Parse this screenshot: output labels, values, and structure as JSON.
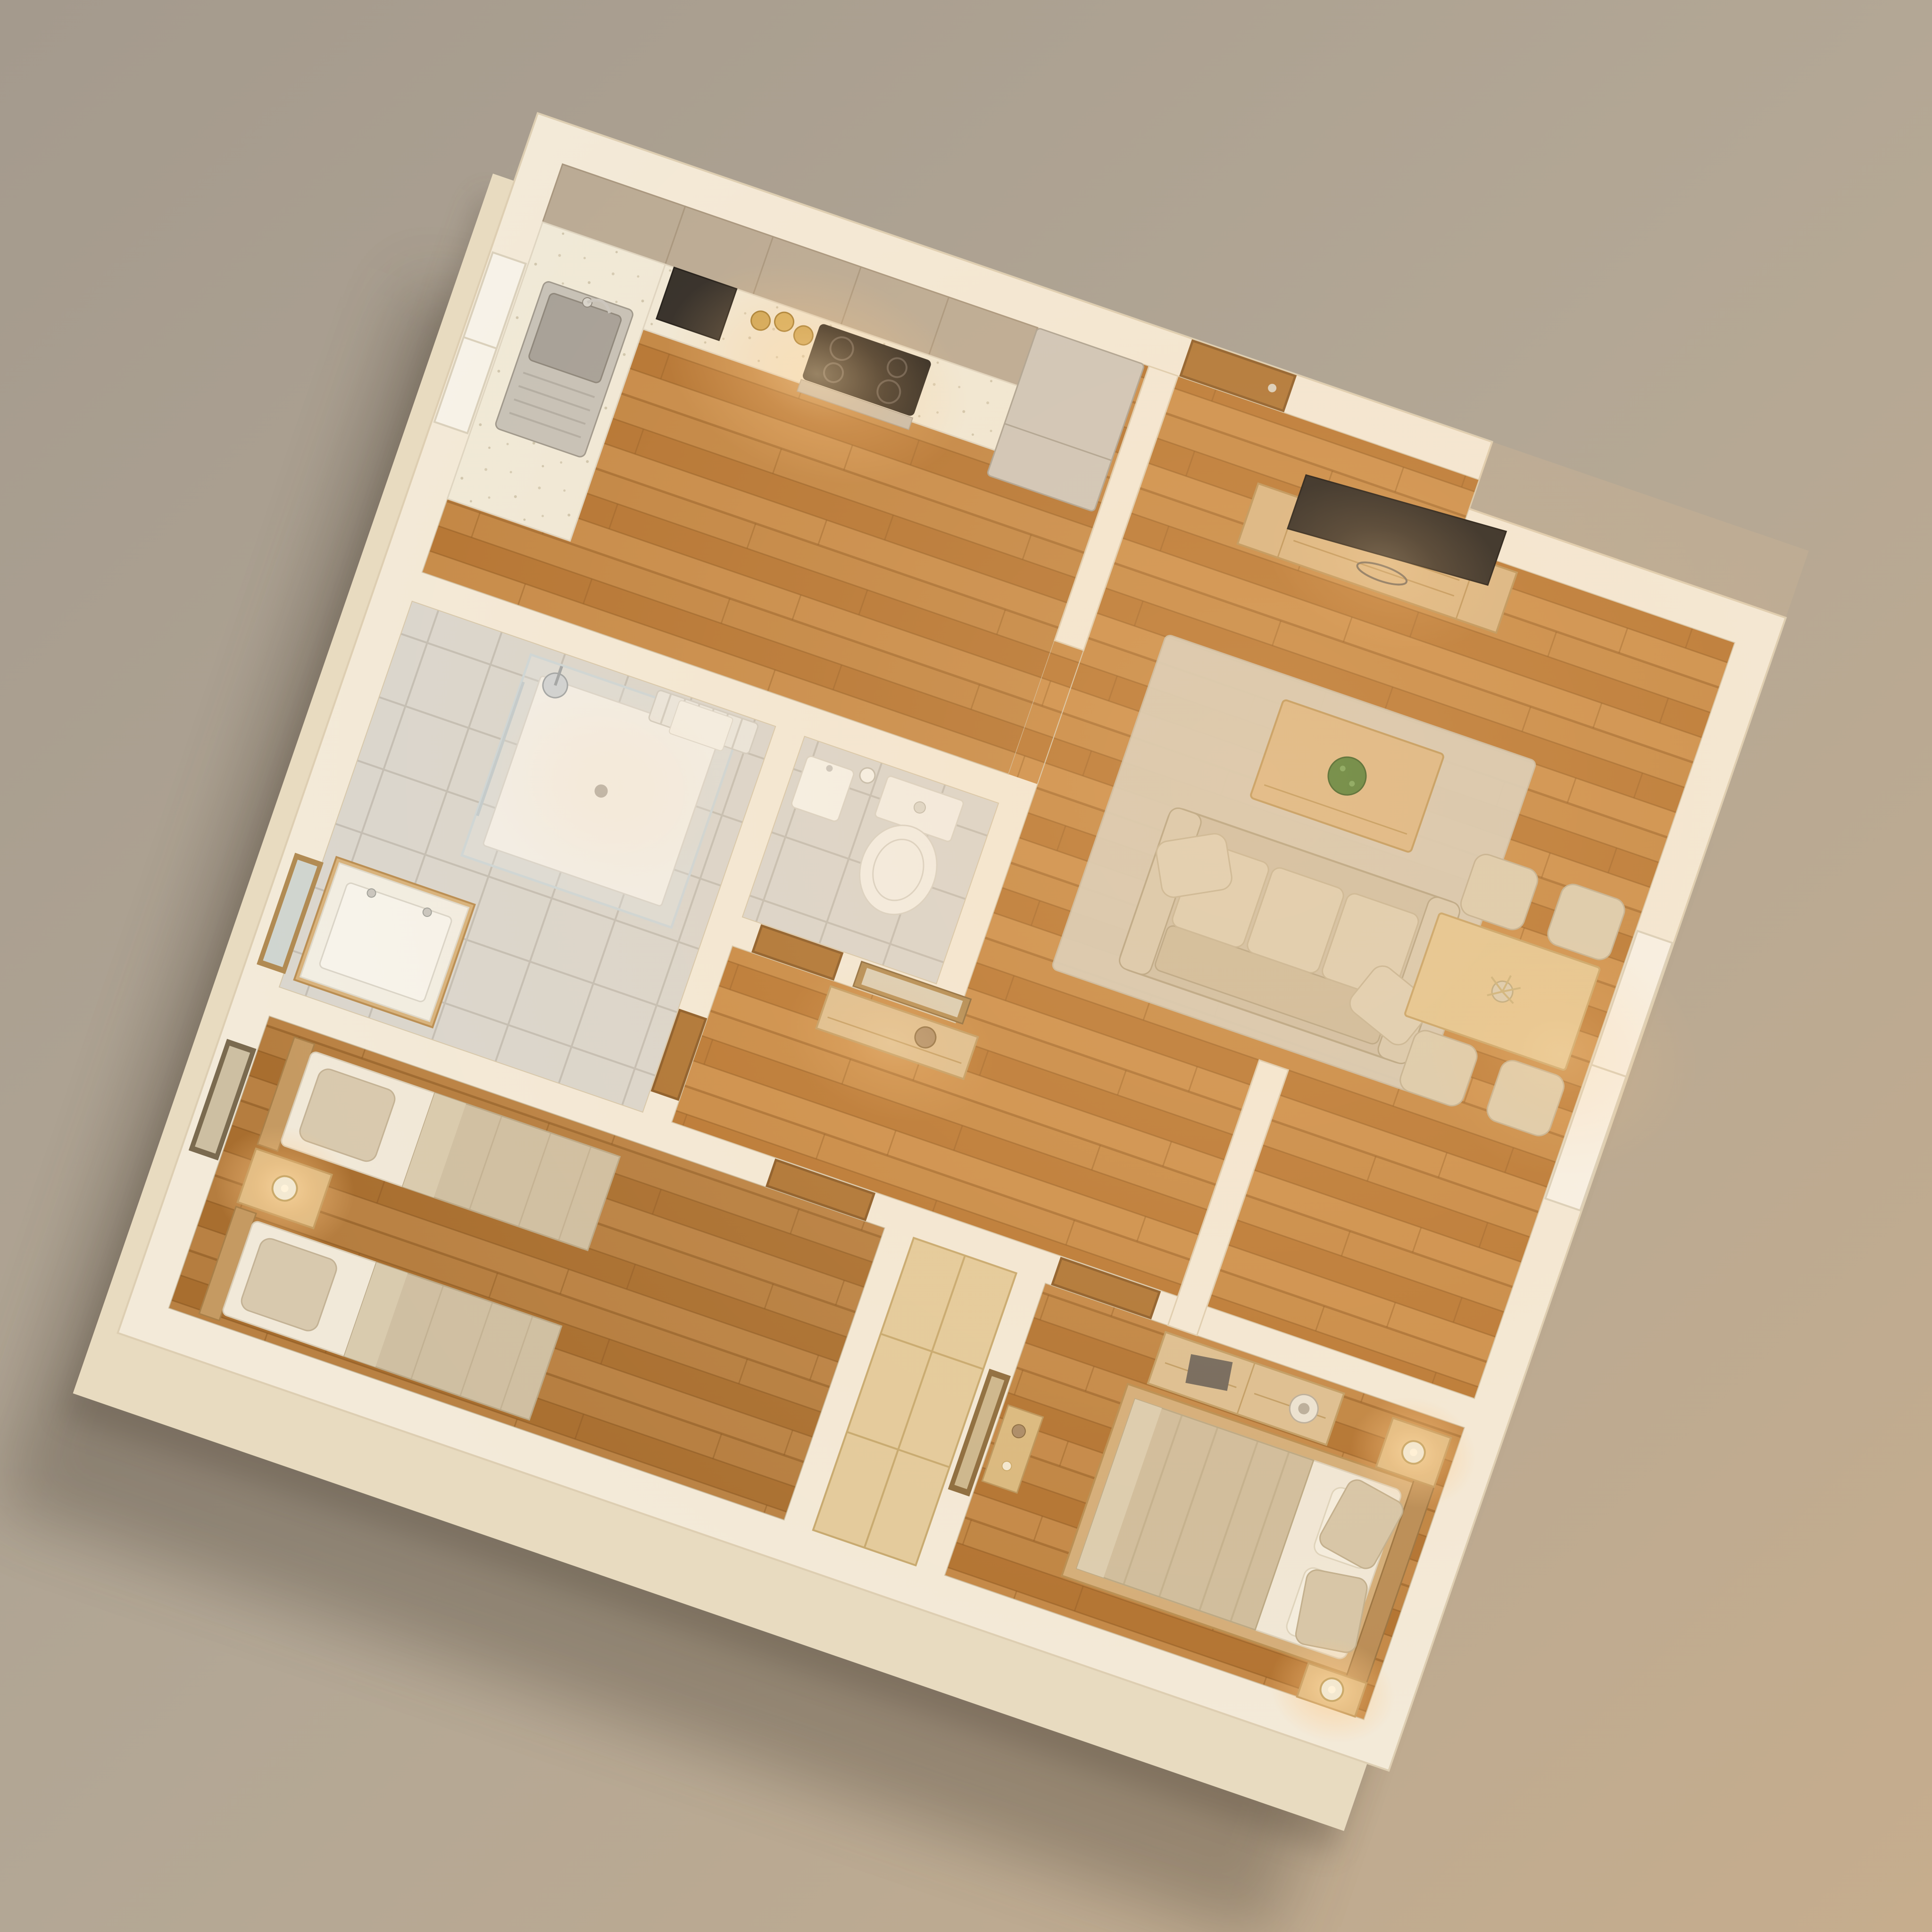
{
  "scene": {
    "type": "3d-floor-plan-render",
    "description": "Isometric top-down 3D render of a two-bedroom apartment miniature model, warm evening lighting, on a plain beige studio background",
    "rotation_deg": 19,
    "text_labels": []
  },
  "palette": {
    "background_top": "#a49a8d",
    "background_mid": "#b3a795",
    "background_bottom": "#c6ad8d",
    "wall_top": "#f3ead9",
    "wall_side": "#e8dbc0",
    "cast_shadow": "#3a3028",
    "floor_wood": "#c08038",
    "floor_tile": "#dad6ce",
    "door_wood": "#ad7434",
    "door_frame": "#8a5a26",
    "cabinet_greige": "#b9aa95",
    "countertop": "#f0ead9",
    "stainless": "#cdc6bb",
    "cooktop_black": "#191715",
    "textile_beige": "#cfc0a6",
    "textile_white": "#f1e9d9",
    "blanket_beige": "#cfbd9d",
    "oak_furniture": "#d9b684",
    "wardrobe_oak": "#e3cb9c",
    "rug": "#d7cdb9",
    "plant_green": "#58813a",
    "lamp_glow": "#ffd9a0",
    "glass": "#cdd6d8"
  },
  "rooms": [
    {
      "name": "kitchen",
      "floor": "wood",
      "furniture": [
        "upper-cabinets",
        "corner-cabinet",
        "speckled-countertop",
        "microwave",
        "gold-canisters",
        "induction-cooktop",
        "oven",
        "stainless-sink",
        "fridge",
        "window"
      ]
    },
    {
      "name": "living-room",
      "floor": "wood",
      "furniture": [
        "entrance-door",
        "tv-console",
        "flat-tv",
        "area-rug",
        "coffee-table",
        "green-plant",
        "three-seat-sofa",
        "throw-pillows"
      ]
    },
    {
      "name": "dining-area",
      "floor": "wood",
      "furniture": [
        "dining-table",
        "flower-centerpiece",
        "chair",
        "chair",
        "chair",
        "chair",
        "tall-window"
      ]
    },
    {
      "name": "bathroom",
      "floor": "tile",
      "furniture": [
        "walk-in-shower",
        "shower-head",
        "towel-radiator",
        "vanity-sink",
        "wall-mirror",
        "door"
      ]
    },
    {
      "name": "wc",
      "floor": "tile",
      "furniture": [
        "toilet",
        "corner-sink",
        "toilet-paper-holder",
        "door"
      ]
    },
    {
      "name": "hallway",
      "floor": "wood",
      "furniture": [
        "console-table",
        "wall-mirror",
        "decor-bowl"
      ]
    },
    {
      "name": "bedroom-twin",
      "floor": "wood",
      "furniture": [
        "single-bed",
        "single-bed",
        "shared-nightstand",
        "lit-table-lamp",
        "wall-art",
        "door"
      ]
    },
    {
      "name": "bedroom-master",
      "floor": "wood",
      "furniture": [
        "double-bed",
        "nightstand",
        "nightstand",
        "lit-table-lamp",
        "lit-table-lamp",
        "dresser",
        "book",
        "decor-bowl",
        "console-shelf",
        "leaning-mirror",
        "door"
      ]
    },
    {
      "name": "built-in-wardrobe",
      "floor": "oak-top",
      "furniture": [
        "closet-doors"
      ]
    }
  ],
  "lighting": {
    "lit_lamps": 3,
    "ambient": "warm",
    "glow_spots": [
      "kitchen-counter",
      "twin-bedroom-lamp",
      "master-lamp-north",
      "master-lamp-south",
      "hallway",
      "dining-window"
    ]
  }
}
